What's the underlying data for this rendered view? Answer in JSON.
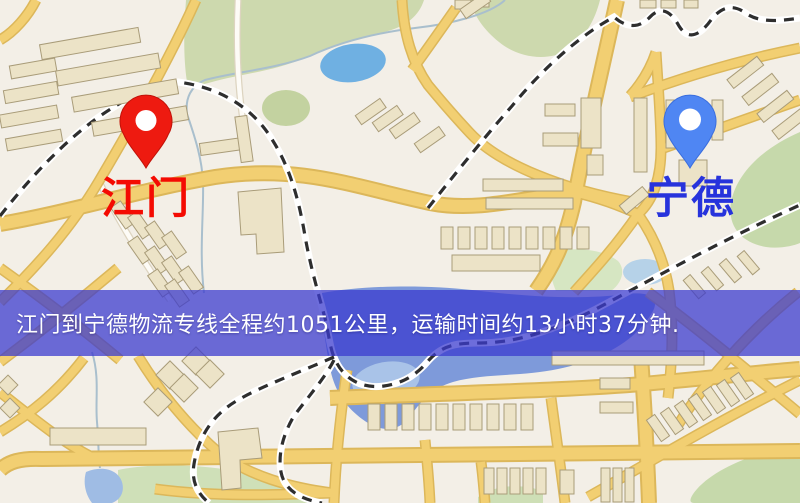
{
  "map": {
    "origin_marker": {
      "label": "江门",
      "pin_color": "#ee1a10",
      "pin_border": "#c11208",
      "label_color": "#f40b02"
    },
    "destination_marker": {
      "label": "宁德",
      "pin_color": "#4f86f3",
      "pin_border": "#3a6ede",
      "label_color": "#2733dc"
    },
    "banner": {
      "text": "江门到宁德物流专线全程约1051公里，运输时间约13小时37分钟.",
      "background": "rgba(58,58,206,0.74)",
      "text_color": "#ffffff"
    },
    "route": {
      "origin": "江门",
      "destination": "宁德",
      "distance_text": "约1051公里",
      "duration_text": "约13小时37分钟"
    },
    "palette": {
      "land": "#f3efe7",
      "road_major": "#f2cf72",
      "park": "#cdd9ae",
      "water": "#7e9ada",
      "railway": "#2e2e2e"
    }
  }
}
